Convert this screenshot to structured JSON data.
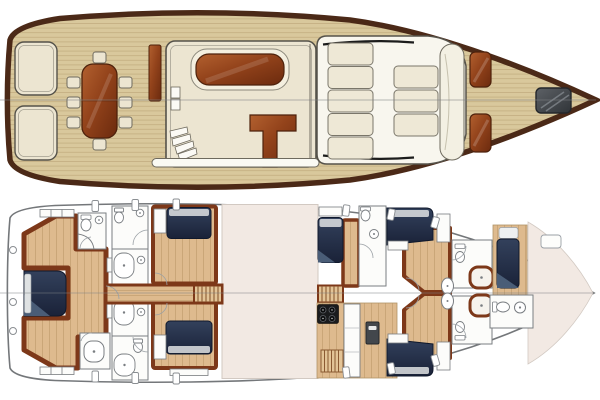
{
  "image": {
    "kind": "yacht-deck-plan-drawing",
    "views": [
      {
        "id": "main-deck-plan",
        "position": "top"
      },
      {
        "id": "lower-deck-plan",
        "position": "bottom"
      }
    ]
  },
  "palette": {
    "page_bg": "#ffffff",
    "hull_border": "#4b2917",
    "teak": "#d9c89c",
    "teak_line": "#b9a274",
    "cream": "#ece5d1",
    "outline_dark": "#55524a",
    "mahogany_light": "#b2602f",
    "mahogany_mid": "#93431b",
    "mahogany_dark": "#6b2a0e",
    "mahogany_stroke": "#4e220c",
    "pad_white": "#f8f6ee",
    "cushion": "#eee8d6",
    "hatch_gray_light": "#5d6166",
    "hatch_gray_dark": "#303438",
    "lower_hull": "#74777a",
    "blank_beige": "#f2e9e3",
    "wood_floor": "#deba8e",
    "wood_line": "#bf9a6a",
    "trim": "#7d3819",
    "navy_dark": "#1a2238",
    "navy_mid": "#33415c",
    "navy_wedge": "#4a5d77",
    "pillow": "#dfe2e3",
    "bath_white": "#fcfcfa",
    "fixture_stroke": "#7a7e82",
    "stair_wood": "#e3c497",
    "stair_line": "#8a5a32",
    "black_trim": "#1c1c1c",
    "centerline": "#7d8083"
  },
  "upper_deck": {
    "features": {
      "stern_benches": 2,
      "dining_table": 1,
      "dining_chairs": 8,
      "companionway_panel": 1,
      "deckhouse": 1,
      "cabin_skylight": 1,
      "l_shaped_settee": 1,
      "companionway_steps": 4,
      "sunpad_sections_aft": 5,
      "sunpad_sections_forward": 3,
      "bow_bolster": 1,
      "wooden_deck_hatches": 2,
      "dark_foredeck_hatch": 1
    }
  },
  "lower_deck": {
    "features": {
      "berths": 7,
      "toilets": 7,
      "washbasins": 8,
      "shower_stalls": 6,
      "stair_flights": 2,
      "stove_burners": 4,
      "galley_appliance": 1,
      "floor_gratings": 1,
      "engine_room_blank": 1,
      "bow_blank": 1,
      "portholes": 15
    }
  }
}
